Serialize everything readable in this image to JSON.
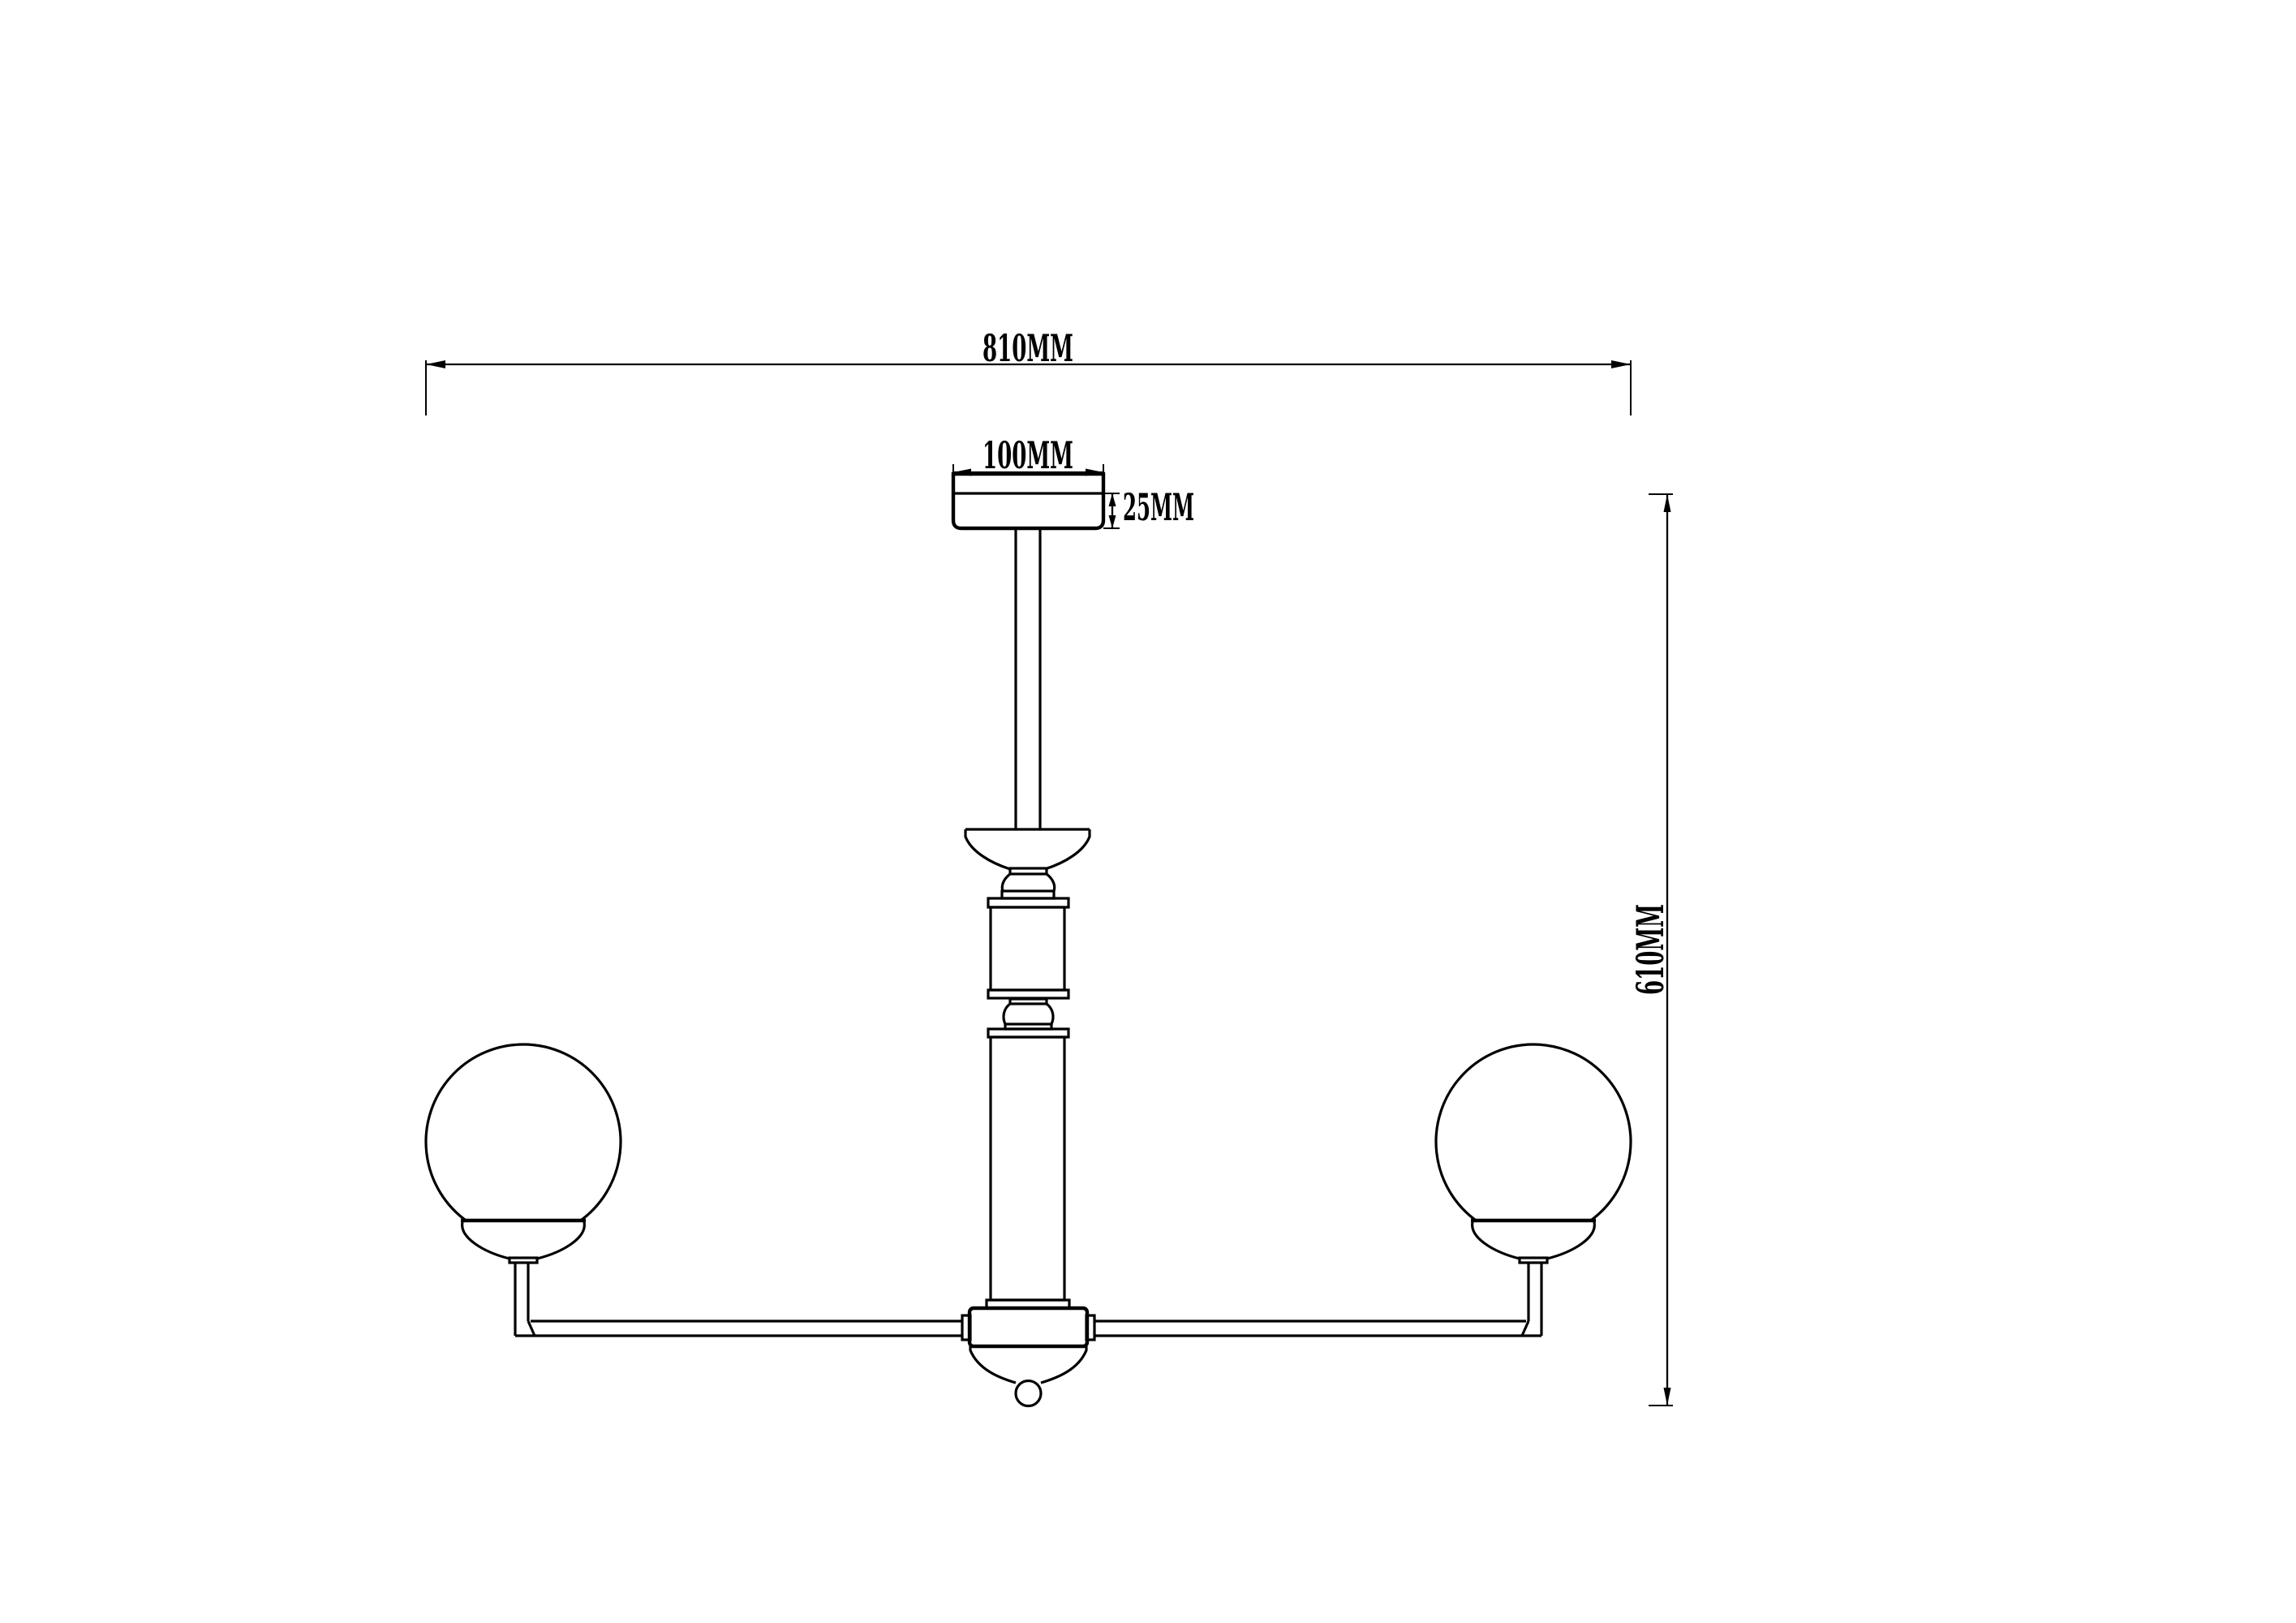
{
  "page": {
    "background_color": "#ffffff",
    "line_color": "#000000"
  },
  "dimensions": {
    "overall_width_label": "810MM",
    "canopy_width_label": "100MM",
    "canopy_height_label": "25MM",
    "overall_height_label": "610MM"
  }
}
